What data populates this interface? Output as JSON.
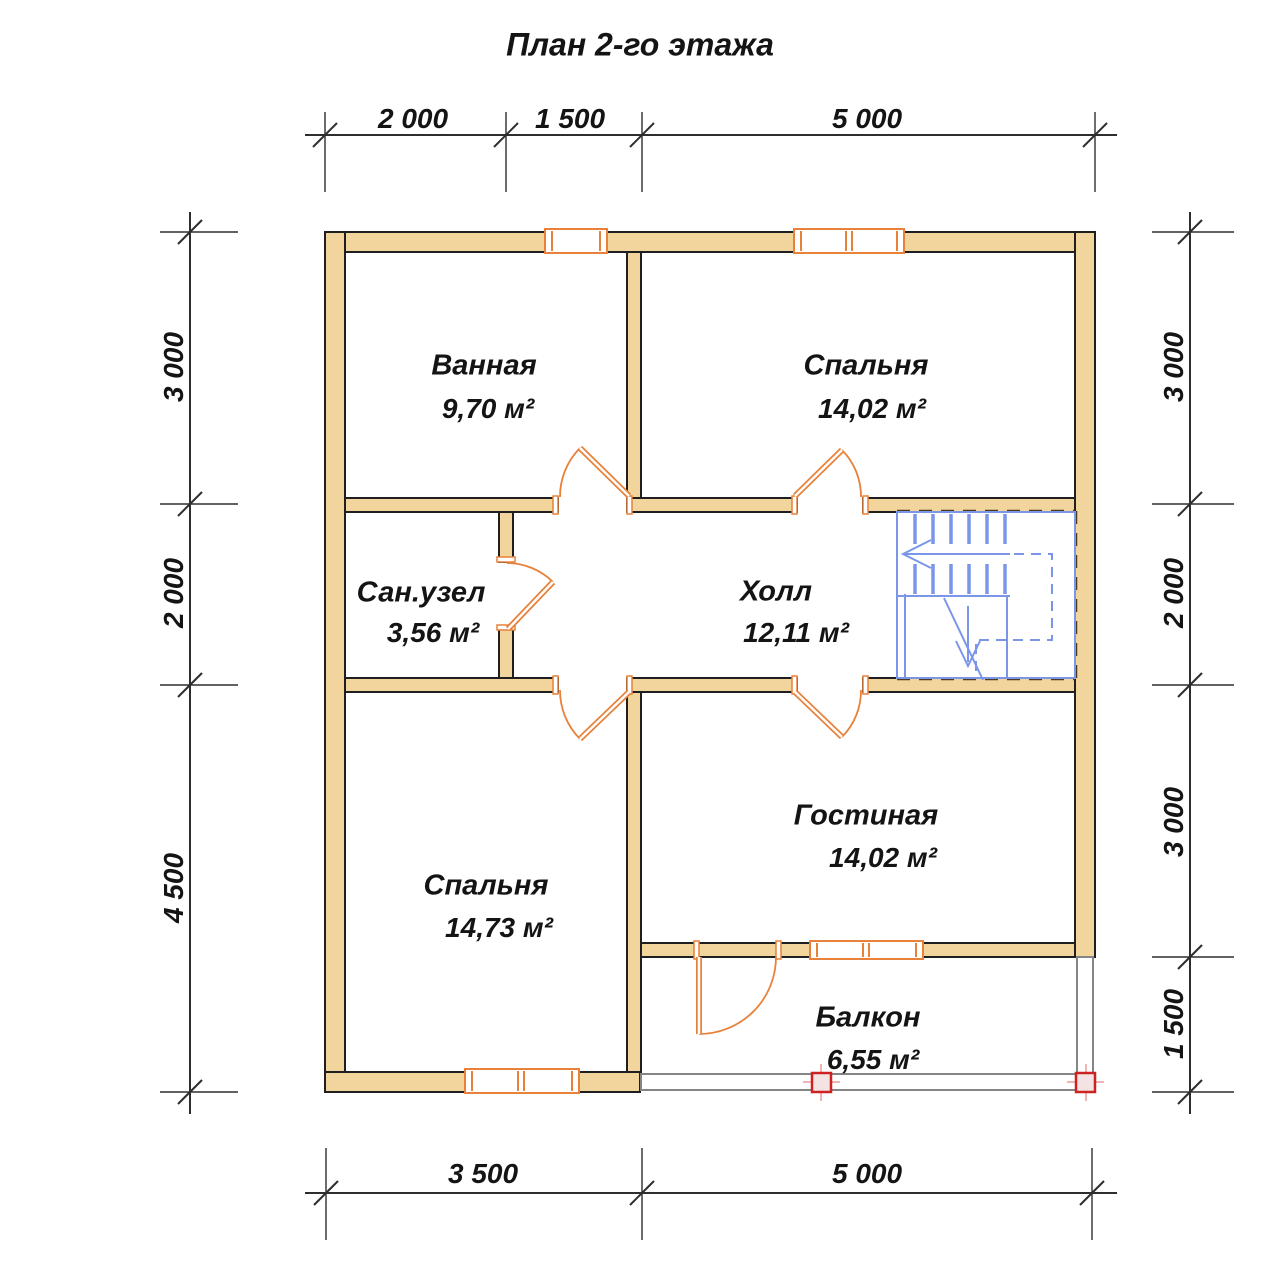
{
  "title": "План 2-го этажа",
  "rooms": [
    {
      "id": "bathroom",
      "name": "Ванная",
      "area": "9,70 м²"
    },
    {
      "id": "bedroom-top",
      "name": "Спальня",
      "area": "14,02 м²"
    },
    {
      "id": "wc",
      "name": "Сан.узел",
      "area": "3,56 м²"
    },
    {
      "id": "hall",
      "name": "Холл",
      "area": "12,11 м²"
    },
    {
      "id": "bedroom-bottom",
      "name": "Спальня",
      "area": "14,73 м²"
    },
    {
      "id": "living-room",
      "name": "Гостиная",
      "area": "14,02 м²"
    },
    {
      "id": "balcony",
      "name": "Балкон",
      "area": "6,55 м²"
    }
  ],
  "dimensions": {
    "top": [
      "2 000",
      "1 500",
      "5 000"
    ],
    "bottom": [
      "3 500",
      "5 000"
    ],
    "left": [
      "3 000",
      "2 000",
      "4 500"
    ],
    "right": [
      "3 000",
      "2 000",
      "3 000",
      "1 500"
    ]
  },
  "colors": {
    "wall_fill": "#f2d59c",
    "wall_outline": "#1f1f1f",
    "door_window": "#e8813a",
    "stairs": "#7b96e8",
    "balcony_post": "#cc2222"
  }
}
